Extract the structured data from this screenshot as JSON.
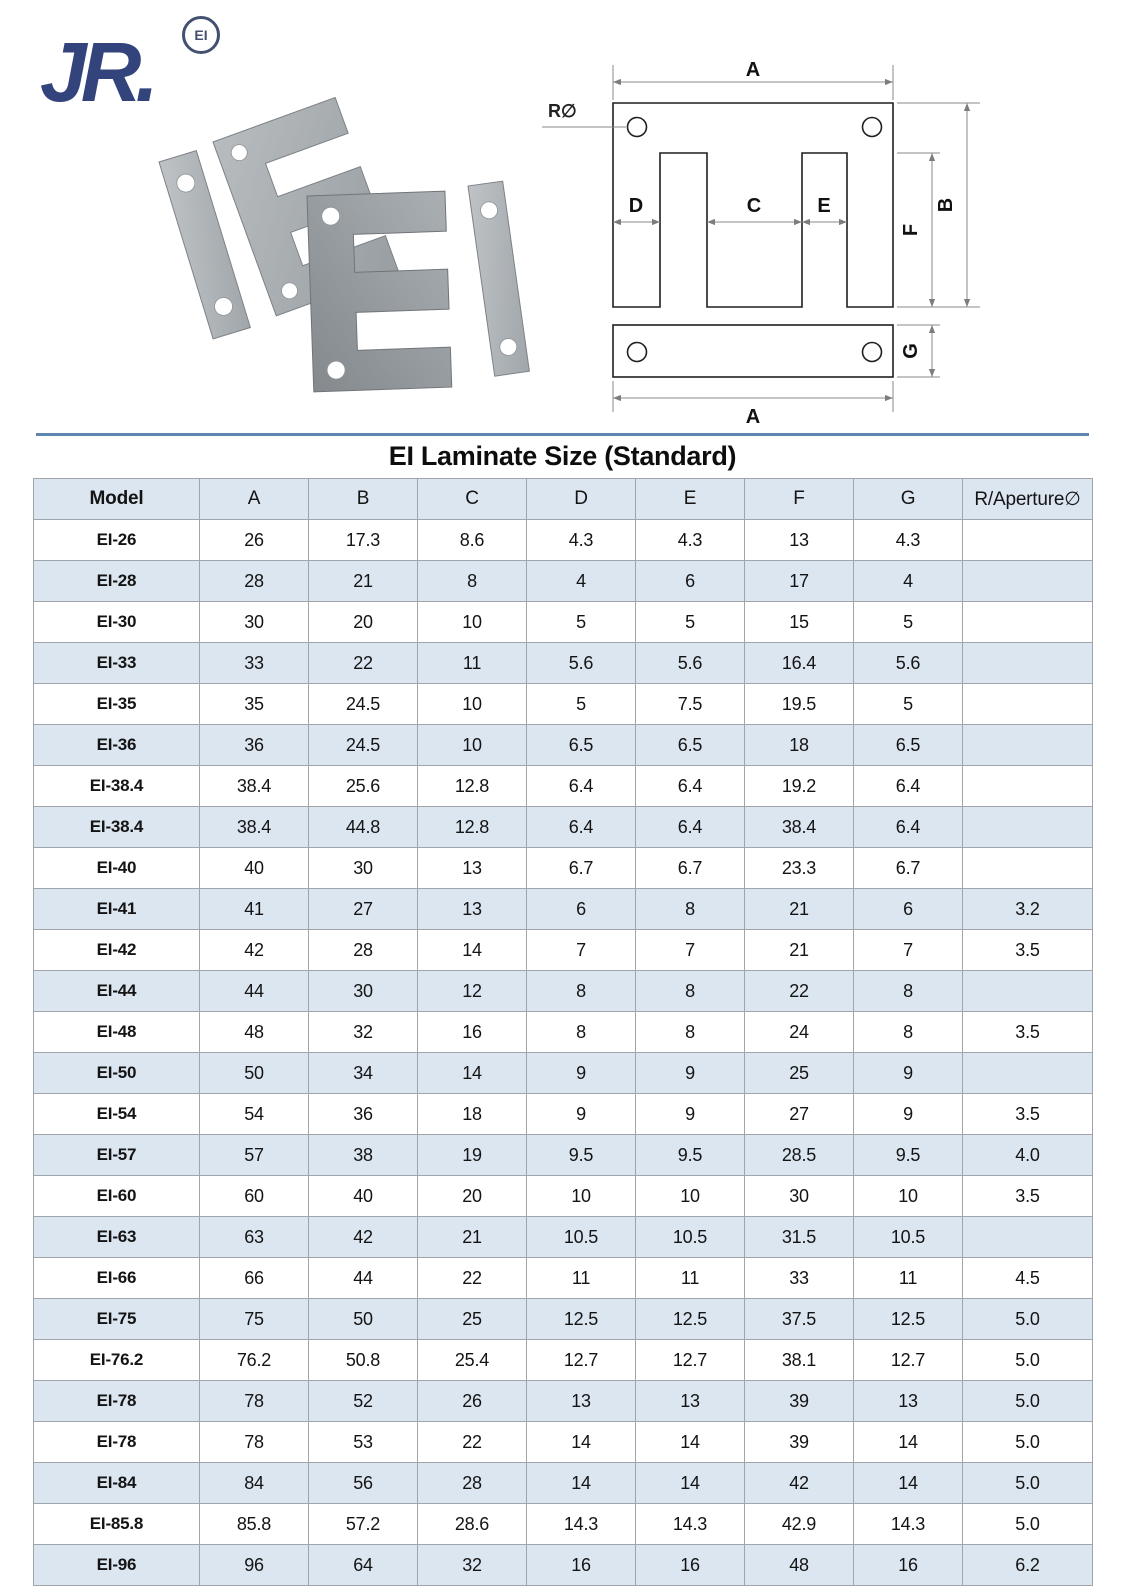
{
  "logo": {
    "brand": "JR.",
    "mark": "EI"
  },
  "colors": {
    "brand_navy": "#33437b",
    "divider_blue": "#5e87b0",
    "row_blue": "#dce6f1",
    "table_border": "#9fa5ab"
  },
  "diagram": {
    "labels": {
      "width_top": "A",
      "radius": "R∅",
      "leg_left": "D",
      "center_leg": "C",
      "window": "E",
      "leg_height": "F",
      "height": "B",
      "bar_height": "G",
      "width_bottom": "A"
    }
  },
  "table": {
    "title": "EI Laminate Size (Standard)",
    "columns": [
      "Model",
      "A",
      "B",
      "C",
      "D",
      "E",
      "F",
      "G",
      "R/Aperture∅"
    ],
    "rows": [
      [
        "EI-26",
        "26",
        "17.3",
        "8.6",
        "4.3",
        "4.3",
        "13",
        "4.3",
        ""
      ],
      [
        "EI-28",
        "28",
        "21",
        "8",
        "4",
        "6",
        "17",
        "4",
        ""
      ],
      [
        "EI-30",
        "30",
        "20",
        "10",
        "5",
        "5",
        "15",
        "5",
        ""
      ],
      [
        "EI-33",
        "33",
        "22",
        "11",
        "5.6",
        "5.6",
        "16.4",
        "5.6",
        ""
      ],
      [
        "EI-35",
        "35",
        "24.5",
        "10",
        "5",
        "7.5",
        "19.5",
        "5",
        ""
      ],
      [
        "EI-36",
        "36",
        "24.5",
        "10",
        "6.5",
        "6.5",
        "18",
        "6.5",
        ""
      ],
      [
        "EI-38.4",
        "38.4",
        "25.6",
        "12.8",
        "6.4",
        "6.4",
        "19.2",
        "6.4",
        ""
      ],
      [
        "EI-38.4",
        "38.4",
        "44.8",
        "12.8",
        "6.4",
        "6.4",
        "38.4",
        "6.4",
        ""
      ],
      [
        "EI-40",
        "40",
        "30",
        "13",
        "6.7",
        "6.7",
        "23.3",
        "6.7",
        ""
      ],
      [
        "EI-41",
        "41",
        "27",
        "13",
        "6",
        "8",
        "21",
        "6",
        "3.2"
      ],
      [
        "EI-42",
        "42",
        "28",
        "14",
        "7",
        "7",
        "21",
        "7",
        "3.5"
      ],
      [
        "EI-44",
        "44",
        "30",
        "12",
        "8",
        "8",
        "22",
        "8",
        ""
      ],
      [
        "EI-48",
        "48",
        "32",
        "16",
        "8",
        "8",
        "24",
        "8",
        "3.5"
      ],
      [
        "EI-50",
        "50",
        "34",
        "14",
        "9",
        "9",
        "25",
        "9",
        ""
      ],
      [
        "EI-54",
        "54",
        "36",
        "18",
        "9",
        "9",
        "27",
        "9",
        "3.5"
      ],
      [
        "EI-57",
        "57",
        "38",
        "19",
        "9.5",
        "9.5",
        "28.5",
        "9.5",
        "4.0"
      ],
      [
        "EI-60",
        "60",
        "40",
        "20",
        "10",
        "10",
        "30",
        "10",
        "3.5"
      ],
      [
        "EI-63",
        "63",
        "42",
        "21",
        "10.5",
        "10.5",
        "31.5",
        "10.5",
        ""
      ],
      [
        "EI-66",
        "66",
        "44",
        "22",
        "11",
        "11",
        "33",
        "11",
        "4.5"
      ],
      [
        "EI-75",
        "75",
        "50",
        "25",
        "12.5",
        "12.5",
        "37.5",
        "12.5",
        "5.0"
      ],
      [
        "EI-76.2",
        "76.2",
        "50.8",
        "25.4",
        "12.7",
        "12.7",
        "38.1",
        "12.7",
        "5.0"
      ],
      [
        "EI-78",
        "78",
        "52",
        "26",
        "13",
        "13",
        "39",
        "13",
        "5.0"
      ],
      [
        "EI-78",
        "78",
        "53",
        "22",
        "14",
        "14",
        "39",
        "14",
        "5.0"
      ],
      [
        "EI-84",
        "84",
        "56",
        "28",
        "14",
        "14",
        "42",
        "14",
        "5.0"
      ],
      [
        "EI-85.8",
        "85.8",
        "57.2",
        "28.6",
        "14.3",
        "14.3",
        "42.9",
        "14.3",
        "5.0"
      ],
      [
        "EI-96",
        "96",
        "64",
        "32",
        "16",
        "16",
        "48",
        "16",
        "6.2"
      ]
    ]
  }
}
